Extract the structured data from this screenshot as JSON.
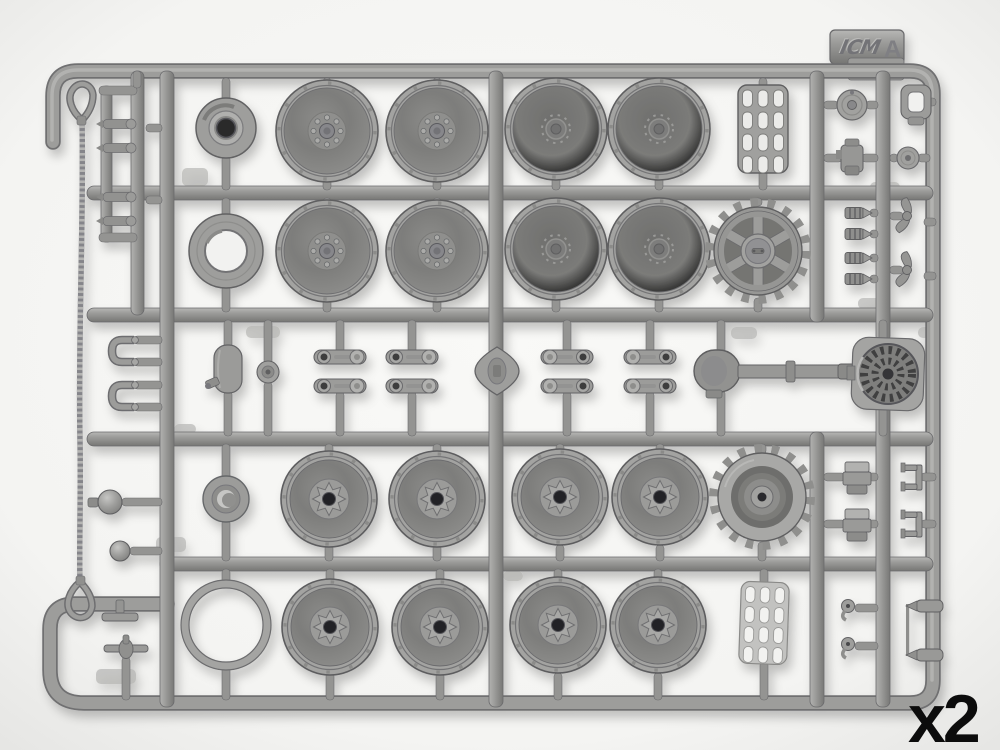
{
  "photo": {
    "subject": "injection-molded plastic model kit sprue, grey styrene, photographed on white background",
    "brand_logo": "ICM",
    "sprue_letter": "A",
    "quantity_label": "x2"
  },
  "colors": {
    "background": "#f6f6f4",
    "plastic_mid": "#9a9a98",
    "plastic_light": "#bcbcba",
    "plastic_dark": "#6e6e70",
    "hole_dark": "#26262a",
    "quantity_text": "#0c0c0c"
  },
  "parts_inventory": [
    {
      "name": "tow-cable-with-eyelets",
      "count": 1
    },
    {
      "name": "hub-cap-large",
      "count": 1
    },
    {
      "name": "road-wheel-outer-half-bolted-hub",
      "count": 4
    },
    {
      "name": "road-wheel-inner-half-plain-hub",
      "count": 4
    },
    {
      "name": "road-wheel-star-hub",
      "count": 8
    },
    {
      "name": "wheel-ring-spacer",
      "count": 1
    },
    {
      "name": "open-ring",
      "count": 1
    },
    {
      "name": "drive-sprocket-inner-half",
      "count": 1
    },
    {
      "name": "drive-sprocket-outer-half",
      "count": 1
    },
    {
      "name": "engine-grille-plate",
      "count": 2
    },
    {
      "name": "cooling-fan-housing",
      "count": 1
    },
    {
      "name": "muffler-with-exhaust-pipe",
      "count": 1
    },
    {
      "name": "suspension-link-arm",
      "count": 8
    },
    {
      "name": "tow-shackle",
      "count": 2
    },
    {
      "name": "coil-spring",
      "count": 4
    },
    {
      "name": "axle-pin",
      "count": 4
    },
    {
      "name": "small-fittings",
      "count": 18
    }
  ]
}
